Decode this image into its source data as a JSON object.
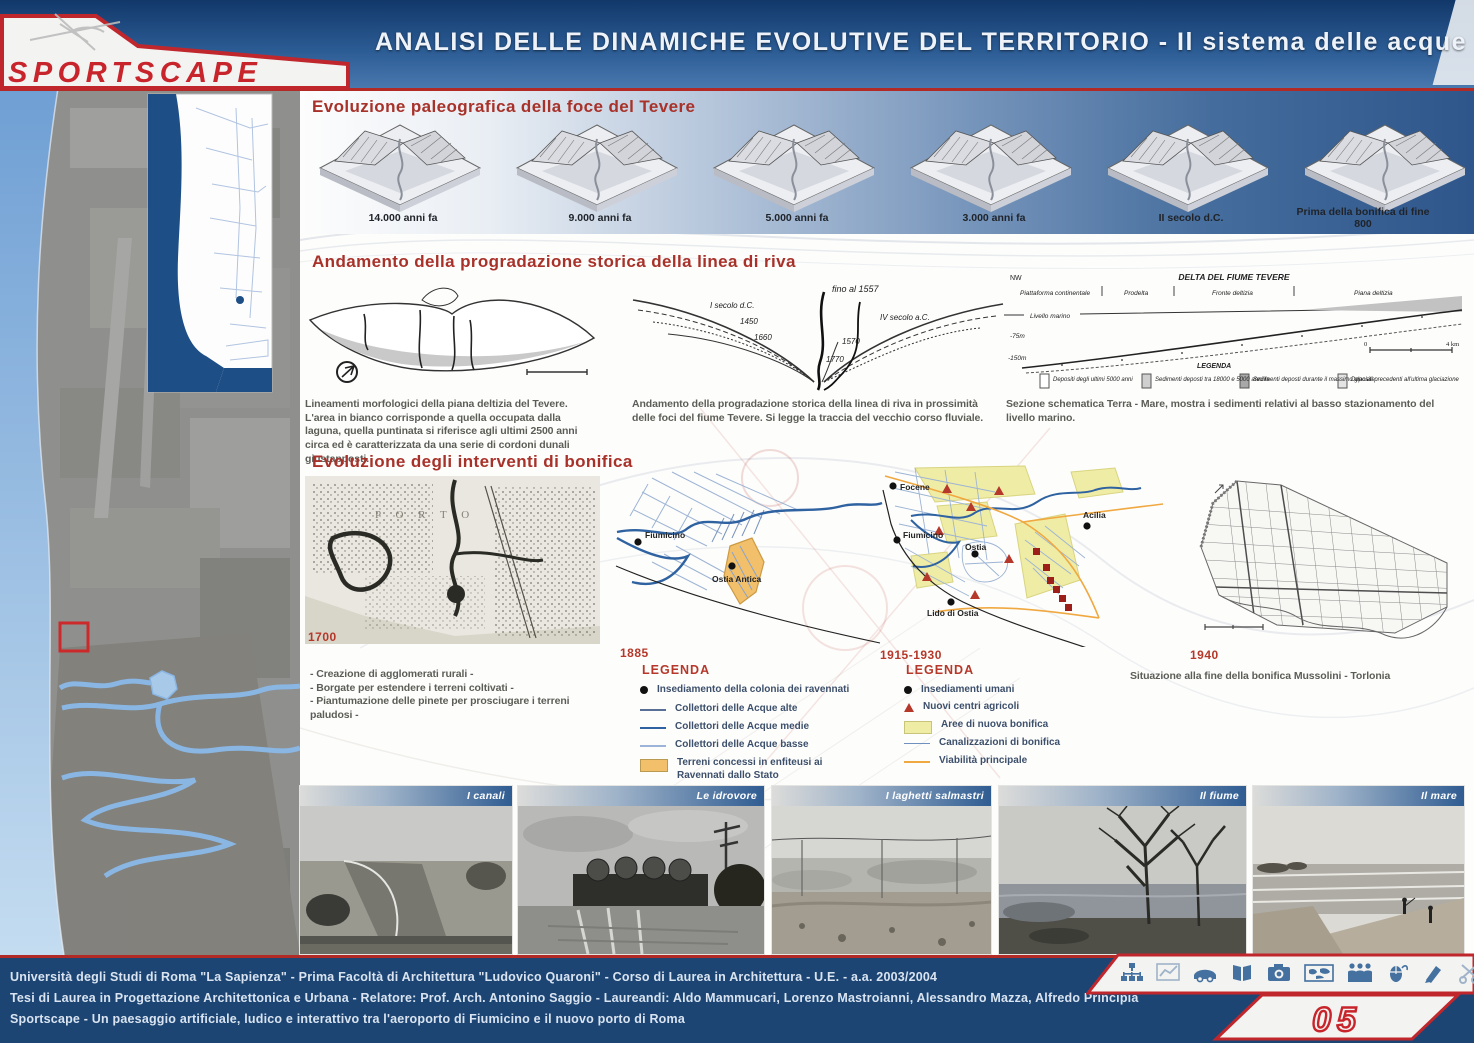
{
  "header": {
    "title": "ANALISI DELLE DINAMICHE EVOLUTIVE DEL TERRITORIO - Il sistema delle acque",
    "logo_text": "SPORTSCAPE"
  },
  "sections": {
    "paleo": {
      "title": "Evoluzione paleografica della foce del Tevere",
      "stages": [
        "14.000 anni fa",
        "9.000 anni fa",
        "5.000 anni fa",
        "3.000 anni fa",
        "II secolo d.C.",
        "Prima della bonifica di fine 800"
      ]
    },
    "prograd": {
      "title": "Andamento della progradazione storica della linea di riva",
      "caption_morfologia": "Lineamenti morfologici della piana deltizia del Tevere. L'area in bianco corrisponde a quella occupata dalla laguna, quella puntinata si riferisce agli ultimi 2500 anni circa ed è caratterizzata da una serie di cordoni dunali giustapposti.",
      "caption_foci": "Andamento della progradazione storica della linea di riva in prossimità delle foci del fiume Tevere. Si legge la traccia del vecchio corso fluviale.",
      "caption_sezione": "Sezione schematica Terra - Mare, mostra i sedimenti relativi al basso stazionamento del livello marino.",
      "shore_years": [
        "fino al 1557",
        "I secolo d.C.",
        "1450",
        "1660",
        "IV secolo a.C.",
        "1570",
        "1770"
      ],
      "section_diagram": {
        "title": "DELTA DEL FIUME TEVERE",
        "corner": "NW",
        "zones": [
          "Piattaforma continentale",
          "Prodelta",
          "Fronte deltizia",
          "Piana deltizia"
        ],
        "sea_level": "Livello marino",
        "depths": [
          "-75m",
          "-150m"
        ],
        "legend_title": "LEGENDA",
        "legend": [
          "Depositi degli ultimi 5000 anni",
          "Sedimenti deposti tra 18000 e 5000 anni fa",
          "Sedimenti deposti durante il massimo glaciale",
          "Depositi precedenti all'ultima glaciazione"
        ],
        "scale_start": "0",
        "scale_end": "4 km"
      }
    },
    "bonifica": {
      "title": "Evoluzione degli interventi di bonifica",
      "map1700": {
        "year": "1700",
        "inscription": "P O R T O",
        "bullets": [
          "- Creazione di agglomerati rurali -",
          "- Borgate per estendere i terreni coltivati -",
          "- Piantumazione delle pinete per prosciugare i terreni paludosi -"
        ]
      },
      "map1885": {
        "year": "1885",
        "legend_title": "LEGENDA",
        "places": [
          "Fiumicino",
          "Ostia Antica"
        ],
        "legend": [
          "Insediamento della colonia dei ravennati",
          "Collettori delle Acque alte",
          "Collettori delle Acque medie",
          "Collettori delle Acque basse",
          "Terreni concessi in enfiteusi ai Ravennati dallo Stato"
        ]
      },
      "map1915": {
        "year": "1915-1930",
        "legend_title": "LEGENDA",
        "places": [
          "Focene",
          "Fiumicino",
          "Acilia",
          "Ostia",
          "Lido di Ostia"
        ],
        "legend": [
          "Insediamenti umani",
          "Nuovi centri agricoli",
          "Aree di nuova bonifica",
          "Canalizzazioni di bonifica",
          "Viabilità principale"
        ]
      },
      "map1940": {
        "year": "1940",
        "caption": "Situazione alla fine della bonifica Mussolini - Torlonia"
      }
    }
  },
  "photos": [
    {
      "label": "I canali"
    },
    {
      "label": "Le idrovore"
    },
    {
      "label": "I laghetti salmastri"
    },
    {
      "label": "Il fiume"
    },
    {
      "label": "Il mare"
    }
  ],
  "footer": {
    "lines": [
      "Università degli Studi di Roma \"La Sapienza\" - Prima Facoltà di Architettura \"Ludovico Quaroni\" - Corso di Laurea in Architettura - U.E. - a.a. 2003/2004",
      "Tesi di Laurea in Progettazione Architettonica e Urbana - Relatore: Prof. Arch. Antonino Saggio - Laureandi: Aldo Mammucari, Lorenzo Mastroianni, Alessandro Mazza, Alfredo Principia",
      "Sportscape - Un paesaggio artificiale, ludico e interattivo tra l'aeroporto di Fiumicino e il nuovo porto di Roma"
    ],
    "page_number": "05",
    "icons": [
      "network",
      "chart",
      "car",
      "book",
      "camera",
      "world-map",
      "people",
      "mouse",
      "pen",
      "scissors"
    ]
  },
  "colors": {
    "accent_red": "#b03228",
    "header_blue_dark": "#12386a",
    "header_blue_light": "#4878ae",
    "footer_blue": "#1d4574",
    "legend_orange": "#f2c06a",
    "legend_yellow": "#efeca6",
    "canal_blue": "#2f62a0",
    "road_orange": "#f0a840"
  }
}
